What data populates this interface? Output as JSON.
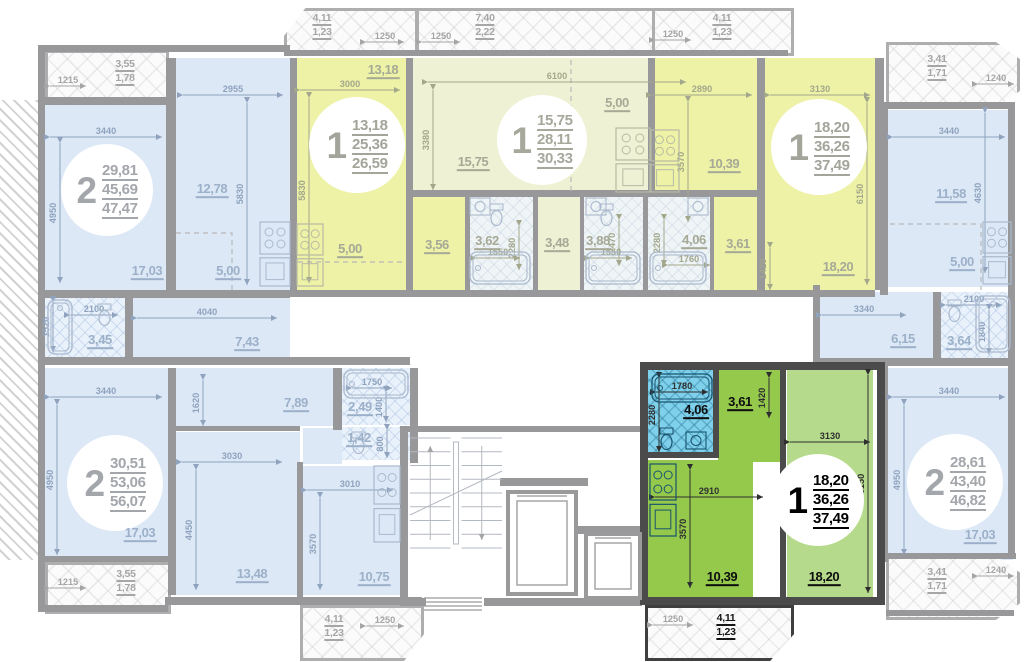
{
  "canvas": {
    "w": 1024,
    "h": 662
  },
  "colors": {
    "wall": "#98989b",
    "wall_selected": "#4b4b4b",
    "room_blue": "#dce8f6",
    "room_yellow": "#edf2a6",
    "room_yellow_pale": "#eef1d3",
    "room_green": "#b6da8c",
    "kitchen_green": "#94c94c",
    "bath_cyan": "#7fd0ea"
  },
  "apartments": [
    {
      "id": "apt-top-left",
      "number": "2",
      "areas": [
        "29,81",
        "45,69",
        "47,47"
      ],
      "cx": 107,
      "cy": 190,
      "d": 92,
      "state": "faded"
    },
    {
      "id": "apt-top-second",
      "number": "1",
      "areas": [
        "13,18",
        "25,36",
        "26,59"
      ],
      "cx": 357,
      "cy": 145,
      "d": 96,
      "state": "hl"
    },
    {
      "id": "apt-top-middle",
      "number": "1",
      "areas": [
        "15,75",
        "28,11",
        "30,33"
      ],
      "cx": 542,
      "cy": 140,
      "d": 90,
      "state": "pale"
    },
    {
      "id": "apt-top-right",
      "number": "1",
      "areas": [
        "18,20",
        "36,26",
        "37,49"
      ],
      "cx": 819,
      "cy": 147,
      "d": 96,
      "state": "hl"
    },
    {
      "id": "apt-right",
      "number": "2",
      "areas": [
        "28,61",
        "43,40",
        "46,82"
      ],
      "cx": 955,
      "cy": 482,
      "d": 96,
      "state": "faded"
    },
    {
      "id": "apt-bottom-left",
      "number": "2",
      "areas": [
        "30,51",
        "53,06",
        "56,07"
      ],
      "cx": 115,
      "cy": 483,
      "d": 96,
      "state": "faded"
    },
    {
      "id": "apt-selected",
      "number": "1",
      "areas": [
        "18,20",
        "36,26",
        "37,49"
      ],
      "cx": 818,
      "cy": 500,
      "d": 92,
      "state": "selected"
    }
  ],
  "rooms": [
    {
      "x": 45,
      "y": 105,
      "w": 123,
      "h": 185,
      "f": "blue",
      "l": "17,03",
      "lx": 147,
      "ly": 272,
      "lc": "b"
    },
    {
      "x": 176,
      "y": 58,
      "w": 116,
      "h": 232,
      "f": "blue",
      "l": "12,78",
      "lx": 212,
      "ly": 190,
      "lc": "b"
    },
    {
      "x": 45,
      "y": 297,
      "w": 80,
      "h": 60,
      "f": "blueTile",
      "l": "3,45",
      "lx": 100,
      "ly": 341,
      "lc": "b"
    },
    {
      "x": 133,
      "y": 297,
      "w": 157,
      "h": 60,
      "f": "blue",
      "l": "7,43",
      "lx": 247,
      "ly": 343,
      "lc": "b"
    },
    {
      "x": 296,
      "y": 58,
      "w": 110,
      "h": 170,
      "f": "yellow",
      "l": "13,18",
      "lx": 383,
      "ly": 71,
      "lc": "y"
    },
    {
      "x": 296,
      "y": 228,
      "w": 110,
      "h": 62,
      "f": "yellow",
      "l": "5,00",
      "lx": 350,
      "ly": 250,
      "lc": "y"
    },
    {
      "x": 410,
      "y": 195,
      "w": 55,
      "h": 95,
      "f": "yellow",
      "l": "3,56",
      "lx": 437,
      "ly": 246,
      "lc": "y"
    },
    {
      "x": 468,
      "y": 195,
      "w": 65,
      "h": 95,
      "f": "tileLight",
      "l": "3,62",
      "lx": 487,
      "ly": 242,
      "lc": "y"
    },
    {
      "x": 413,
      "y": 58,
      "w": 235,
      "h": 137,
      "f": "yellowPale",
      "l": "15,75",
      "lx": 473,
      "ly": 163,
      "lc": "y"
    },
    {
      "x": 537,
      "y": 195,
      "w": 43,
      "h": 95,
      "f": "yellowPale",
      "l": "3,48",
      "lx": 557,
      "ly": 244,
      "lc": "y"
    },
    {
      "x": 583,
      "y": 195,
      "w": 60,
      "h": 95,
      "f": "tileLight",
      "l": "3,88",
      "lx": 598,
      "ly": 242,
      "lc": "y"
    },
    {
      "x": 655,
      "y": 58,
      "w": 102,
      "h": 137,
      "f": "yellow",
      "l": "10,39",
      "lx": 724,
      "ly": 165,
      "lc": "y"
    },
    {
      "x": 765,
      "y": 58,
      "w": 110,
      "h": 232,
      "f": "yellow",
      "l": "18,20",
      "lx": 838,
      "ly": 268,
      "lc": "y"
    },
    {
      "x": 647,
      "y": 195,
      "w": 63,
      "h": 95,
      "f": "tileLight",
      "l": "4,06",
      "lx": 694,
      "ly": 241,
      "lc": "y"
    },
    {
      "x": 713,
      "y": 195,
      "w": 49,
      "h": 95,
      "f": "yellow",
      "l": "3,61",
      "lx": 738,
      "ly": 245,
      "lc": "y"
    },
    {
      "x": 888,
      "y": 110,
      "w": 125,
      "h": 177,
      "f": "blue",
      "l": "11,58",
      "lx": 951,
      "ly": 195,
      "lc": "b"
    },
    {
      "x": 818,
      "y": 292,
      "w": 120,
      "h": 66,
      "f": "blue",
      "l": "6,15",
      "lx": 903,
      "ly": 340,
      "lc": "b"
    },
    {
      "x": 941,
      "y": 292,
      "w": 72,
      "h": 66,
      "f": "blueTile",
      "l": "3,64",
      "lx": 959,
      "ly": 342,
      "lc": "b"
    },
    {
      "x": 888,
      "y": 368,
      "w": 125,
      "h": 192,
      "f": "blue",
      "l": "17,03",
      "lx": 980,
      "ly": 536,
      "lc": "b"
    },
    {
      "x": 45,
      "y": 368,
      "w": 123,
      "h": 192,
      "f": "blue",
      "l": "17,03",
      "lx": 140,
      "ly": 534,
      "lc": "b"
    },
    {
      "x": 176,
      "y": 368,
      "w": 157,
      "h": 58,
      "f": "blue",
      "l": "7,89",
      "lx": 296,
      "ly": 404,
      "lc": "b"
    },
    {
      "x": 176,
      "y": 432,
      "w": 124,
      "h": 163,
      "f": "blue",
      "l": "13,48",
      "lx": 252,
      "ly": 575,
      "lc": "b"
    },
    {
      "x": 303,
      "y": 428,
      "w": 39,
      "h": 36,
      "f": "blue",
      "l": "",
      "lx": 0,
      "ly": 0,
      "lc": "b"
    },
    {
      "x": 303,
      "y": 466,
      "w": 97,
      "h": 129,
      "f": "blue",
      "l": "10,75",
      "lx": 374,
      "ly": 578,
      "lc": "b"
    },
    {
      "x": 342,
      "y": 368,
      "w": 68,
      "h": 57,
      "f": "blueTile",
      "l": "2,49",
      "lx": 360,
      "ly": 408,
      "lc": "b"
    },
    {
      "x": 342,
      "y": 427,
      "w": 68,
      "h": 33,
      "f": "blueTile",
      "l": "1,42",
      "lx": 359,
      "ly": 439,
      "lc": "b"
    },
    {
      "x": 648,
      "y": 370,
      "w": 67,
      "h": 86,
      "f": "greenBath",
      "l": "4,06",
      "lx": 696,
      "ly": 411,
      "lc": "g"
    },
    {
      "x": 718,
      "y": 370,
      "w": 62,
      "h": 92,
      "f": "greenKit",
      "l": "3,61",
      "lx": 740,
      "ly": 403,
      "lc": "g"
    },
    {
      "x": 648,
      "y": 460,
      "w": 105,
      "h": 137,
      "f": "greenKit",
      "l": "10,39",
      "lx": 722,
      "ly": 578,
      "lc": "g"
    },
    {
      "x": 787,
      "y": 370,
      "w": 86,
      "h": 227,
      "f": "greenRoom",
      "l": "18,20",
      "lx": 824,
      "ly": 578,
      "lc": "g"
    }
  ],
  "extra_labels": [
    {
      "t": "5,00",
      "x": 228,
      "y": 272,
      "c": "b"
    },
    {
      "t": "5,00",
      "x": 617,
      "y": 104,
      "c": "y"
    },
    {
      "t": "5,00",
      "x": 962,
      "y": 263,
      "c": "b"
    }
  ],
  "balconies": [
    {
      "x": 45,
      "y": 50,
      "w": 118,
      "h": 47,
      "v1": "3,55",
      "v2": "1,78",
      "lx": 125,
      "ly": 58,
      "clip": "",
      "sel": 0
    },
    {
      "x": 284,
      "y": 8,
      "w": 128,
      "h": 42,
      "v1": "4,11",
      "v2": "1,23",
      "lx": 322,
      "ly": 12,
      "clip": "tl",
      "sel": 0
    },
    {
      "x": 416,
      "y": 8,
      "w": 268,
      "h": 42,
      "v1": "7,40",
      "v2": "2,22",
      "lx": 485,
      "ly": 12,
      "clip": "",
      "sel": 0
    },
    {
      "x": 652,
      "y": 8,
      "w": 136,
      "h": 42,
      "v1": "4,11",
      "v2": "1,23",
      "lx": 722,
      "ly": 12,
      "clip": "",
      "sel": 0
    },
    {
      "x": 886,
      "y": 42,
      "w": 128,
      "h": 60,
      "v1": "3,41",
      "v2": "1,71",
      "lx": 937,
      "ly": 53,
      "clip": "octr",
      "sel": 0
    },
    {
      "x": 886,
      "y": 556,
      "w": 128,
      "h": 58,
      "v1": "3,41",
      "v2": "1,71",
      "lx": 937,
      "ly": 566,
      "clip": "octr",
      "sel": 0
    },
    {
      "x": 45,
      "y": 562,
      "w": 120,
      "h": 46,
      "v1": "3,55",
      "v2": "1,78",
      "lx": 126,
      "ly": 568,
      "clip": "",
      "sel": 0
    },
    {
      "x": 300,
      "y": 605,
      "w": 118,
      "h": 50,
      "v1": "4,11",
      "v2": "1,23",
      "lx": 334,
      "ly": 613,
      "clip": "br",
      "sel": 0
    },
    {
      "x": 645,
      "y": 605,
      "w": 143,
      "h": 50,
      "v1": "4,11",
      "v2": "1,23",
      "lx": 726,
      "ly": 612,
      "clip": "br",
      "sel": 1
    }
  ],
  "dims": [
    {
      "t": "3440",
      "o": "h",
      "x": 50,
      "y": 137,
      "len": 112,
      "c": "b"
    },
    {
      "t": "4950",
      "o": "v",
      "x": 60,
      "y": 143,
      "len": 140,
      "c": "b"
    },
    {
      "t": "2955",
      "o": "h",
      "x": 183,
      "y": 95,
      "len": 100,
      "c": "b"
    },
    {
      "t": "5830",
      "o": "v",
      "x": 247,
      "y": 103,
      "len": 182,
      "c": "b"
    },
    {
      "t": "1215",
      "o": "h",
      "x": 50,
      "y": 86,
      "len": 36,
      "c": "n"
    },
    {
      "t": "2100",
      "o": "h",
      "x": 70,
      "y": 315,
      "len": 48,
      "c": "b"
    },
    {
      "t": "1520",
      "o": "v",
      "x": 53,
      "y": 302,
      "len": 50,
      "c": "b"
    },
    {
      "t": "4040",
      "o": "h",
      "x": 137,
      "y": 318,
      "len": 140,
      "c": "b"
    },
    {
      "t": "3000",
      "o": "h",
      "x": 300,
      "y": 90,
      "len": 100,
      "c": "y"
    },
    {
      "t": "5830",
      "o": "v",
      "x": 309,
      "y": 98,
      "len": 185,
      "c": "y"
    },
    {
      "t": "1250",
      "o": "h",
      "x": 366,
      "y": 42,
      "len": 38,
      "c": "n"
    },
    {
      "t": "1550",
      "o": "h",
      "x": 476,
      "y": 258,
      "len": 44,
      "c": "y"
    },
    {
      "t": "2280",
      "o": "v",
      "x": 519,
      "y": 226,
      "len": 44,
      "c": "y"
    },
    {
      "t": "6100",
      "o": "h",
      "x": 428,
      "y": 82,
      "len": 258,
      "c": "y"
    },
    {
      "t": "3380",
      "o": "v",
      "x": 433,
      "y": 90,
      "len": 100,
      "c": "y"
    },
    {
      "t": "1250",
      "o": "h",
      "x": 422,
      "y": 42,
      "len": 38,
      "c": "n"
    },
    {
      "t": "1550",
      "o": "h",
      "x": 590,
      "y": 258,
      "len": 42,
      "c": "y"
    },
    {
      "t": "2470",
      "o": "v",
      "x": 619,
      "y": 220,
      "len": 46,
      "c": "y"
    },
    {
      "t": "2890",
      "o": "h",
      "x": 652,
      "y": 95,
      "len": 100,
      "c": "y"
    },
    {
      "t": "3570",
      "o": "v",
      "x": 688,
      "y": 102,
      "len": 120,
      "c": "y"
    },
    {
      "t": "3130",
      "o": "h",
      "x": 770,
      "y": 95,
      "len": 100,
      "c": "y"
    },
    {
      "t": "6150",
      "o": "v",
      "x": 867,
      "y": 103,
      "len": 182,
      "c": "y"
    },
    {
      "t": "1420",
      "o": "v",
      "x": 770,
      "y": 248,
      "len": 42,
      "c": "y"
    },
    {
      "t": "1760",
      "o": "h",
      "x": 668,
      "y": 265,
      "len": 42,
      "c": "y"
    },
    {
      "t": "2280",
      "o": "v",
      "x": 664,
      "y": 220,
      "len": 46,
      "c": "y"
    },
    {
      "t": "1250",
      "o": "h",
      "x": 655,
      "y": 40,
      "len": 36,
      "c": "n"
    },
    {
      "t": "1240",
      "o": "h",
      "x": 978,
      "y": 84,
      "len": 36,
      "c": "n"
    },
    {
      "t": "3440",
      "o": "h",
      "x": 893,
      "y": 137,
      "len": 112,
      "c": "b"
    },
    {
      "t": "4630",
      "o": "v",
      "x": 985,
      "y": 113,
      "len": 160,
      "c": "b"
    },
    {
      "t": "3340",
      "o": "h",
      "x": 822,
      "y": 315,
      "len": 84,
      "c": "b"
    },
    {
      "t": "2100",
      "o": "h",
      "x": 946,
      "y": 305,
      "len": 56,
      "c": "b"
    },
    {
      "t": "1840",
      "o": "v",
      "x": 989,
      "y": 310,
      "len": 44,
      "c": "b"
    },
    {
      "t": "3440",
      "o": "h",
      "x": 893,
      "y": 397,
      "len": 112,
      "c": "b"
    },
    {
      "t": "4950",
      "o": "v",
      "x": 904,
      "y": 405,
      "len": 150,
      "c": "b"
    },
    {
      "t": "1240",
      "o": "h",
      "x": 978,
      "y": 576,
      "len": 36,
      "c": "n"
    },
    {
      "t": "3440",
      "o": "h",
      "x": 50,
      "y": 397,
      "len": 112,
      "c": "b"
    },
    {
      "t": "4950",
      "o": "v",
      "x": 57,
      "y": 405,
      "len": 150,
      "c": "b"
    },
    {
      "t": "1620",
      "o": "v",
      "x": 203,
      "y": 380,
      "len": 46,
      "c": "b"
    },
    {
      "t": "3030",
      "o": "h",
      "x": 182,
      "y": 462,
      "len": 100,
      "c": "b"
    },
    {
      "t": "4450",
      "o": "v",
      "x": 196,
      "y": 470,
      "len": 120,
      "c": "b"
    },
    {
      "t": "3010",
      "o": "h",
      "x": 307,
      "y": 490,
      "len": 86,
      "c": "b"
    },
    {
      "t": "3570",
      "o": "v",
      "x": 320,
      "y": 498,
      "len": 92,
      "c": "b"
    },
    {
      "t": "1750",
      "o": "h",
      "x": 352,
      "y": 388,
      "len": 40,
      "c": "b"
    },
    {
      "t": "1400",
      "o": "v",
      "x": 386,
      "y": 392,
      "len": 30,
      "c": "b"
    },
    {
      "t": "800",
      "o": "v",
      "x": 387,
      "y": 430,
      "len": 28,
      "c": "b"
    },
    {
      "t": "1215",
      "o": "h",
      "x": 50,
      "y": 588,
      "len": 36,
      "c": "n"
    },
    {
      "t": "1250",
      "o": "h",
      "x": 366,
      "y": 626,
      "len": 38,
      "c": "n"
    },
    {
      "t": "1780",
      "o": "h",
      "x": 656,
      "y": 392,
      "len": 52,
      "c": "g"
    },
    {
      "t": "2280",
      "o": "v",
      "x": 659,
      "y": 378,
      "len": 74,
      "c": "g"
    },
    {
      "t": "1420",
      "o": "v",
      "x": 769,
      "y": 378,
      "len": 40,
      "c": "g"
    },
    {
      "t": "3130",
      "o": "h",
      "x": 790,
      "y": 442,
      "len": 80,
      "c": "g"
    },
    {
      "t": "6150",
      "o": "v",
      "x": 868,
      "y": 375,
      "len": 218,
      "c": "g"
    },
    {
      "t": "2910",
      "o": "h",
      "x": 655,
      "y": 497,
      "len": 108,
      "c": "g"
    },
    {
      "t": "3570",
      "o": "v",
      "x": 690,
      "y": 470,
      "len": 118,
      "c": "g"
    },
    {
      "t": "1250",
      "o": "h",
      "x": 653,
      "y": 625,
      "len": 40,
      "c": "n"
    }
  ],
  "walls": [
    [
      38,
      45,
      252,
      7
    ],
    [
      284,
      50,
      504,
      6
    ],
    [
      38,
      45,
      7,
      560
    ],
    [
      38,
      605,
      130,
      7
    ],
    [
      165,
      597,
      257,
      8
    ],
    [
      45,
      97,
      130,
      8
    ],
    [
      166,
      58,
      10,
      232
    ],
    [
      290,
      58,
      7,
      232
    ],
    [
      45,
      290,
      245,
      8
    ],
    [
      290,
      290,
      585,
      7
    ],
    [
      38,
      357,
      372,
      8
    ],
    [
      406,
      58,
      7,
      232
    ],
    [
      413,
      190,
      345,
      7
    ],
    [
      648,
      58,
      7,
      139
    ],
    [
      757,
      58,
      8,
      232
    ],
    [
      465,
      195,
      5,
      95
    ],
    [
      533,
      195,
      5,
      95
    ],
    [
      580,
      195,
      4,
      95
    ],
    [
      643,
      195,
      5,
      95
    ],
    [
      710,
      195,
      4,
      95
    ],
    [
      875,
      58,
      9,
      232
    ],
    [
      880,
      102,
      135,
      7
    ],
    [
      880,
      103,
      8,
      192
    ],
    [
      813,
      285,
      7,
      75
    ],
    [
      933,
      292,
      8,
      66
    ],
    [
      813,
      358,
      200,
      8
    ],
    [
      880,
      366,
      8,
      196
    ],
    [
      886,
      553,
      130,
      6
    ],
    [
      886,
      610,
      128,
      6
    ],
    [
      1008,
      102,
      7,
      456
    ],
    [
      125,
      297,
      8,
      60
    ],
    [
      168,
      368,
      8,
      227
    ],
    [
      333,
      368,
      9,
      62
    ],
    [
      410,
      368,
      8,
      95
    ],
    [
      297,
      462,
      6,
      135
    ],
    [
      176,
      426,
      124,
      5
    ],
    [
      400,
      426,
      240,
      6
    ],
    [
      400,
      432,
      8,
      174
    ],
    [
      484,
      598,
      158,
      8
    ],
    [
      408,
      598,
      18,
      8
    ],
    [
      500,
      478,
      88,
      8
    ],
    [
      578,
      526,
      68,
      8
    ],
    [
      45,
      556,
      128,
      6
    ]
  ],
  "dark_walls": [
    [
      640,
      362,
      245,
      8
    ],
    [
      640,
      362,
      8,
      243
    ],
    [
      877,
      362,
      8,
      243
    ],
    [
      640,
      597,
      245,
      8
    ],
    [
      713,
      366,
      6,
      92
    ],
    [
      648,
      452,
      68,
      6
    ],
    [
      780,
      370,
      6,
      227
    ]
  ],
  "hatch": [
    0,
    100,
    38,
    460
  ],
  "dashes": [
    "M176,233H232V290",
    "M298,262H404",
    "M571,60V193",
    "M890,224H981V290"
  ],
  "fixtures": {
    "kitchen_units": [
      [
        260,
        222,
        30,
        64,
        "b"
      ],
      [
        297,
        224,
        26,
        62,
        "y"
      ],
      [
        616,
        128,
        34,
        64,
        "y"
      ],
      [
        651,
        130,
        28,
        62,
        "y"
      ],
      [
        983,
        222,
        28,
        62,
        "b"
      ],
      [
        374,
        466,
        26,
        76,
        "b"
      ],
      [
        650,
        464,
        26,
        72,
        "g"
      ]
    ],
    "bathtubs": [
      [
        48,
        300,
        24,
        54,
        "b",
        "v"
      ],
      [
        470,
        252,
        60,
        32,
        "b",
        "h"
      ],
      [
        586,
        252,
        54,
        32,
        "b",
        "h"
      ],
      [
        650,
        252,
        56,
        32,
        "b",
        "h"
      ],
      [
        976,
        296,
        34,
        56,
        "b",
        "v"
      ],
      [
        344,
        370,
        64,
        28,
        "b",
        "h"
      ],
      [
        652,
        374,
        60,
        28,
        "g",
        "h"
      ]
    ],
    "toilets": [
      [
        98,
        304,
        "b"
      ],
      [
        490,
        204,
        "b"
      ],
      [
        600,
        204,
        "b"
      ],
      [
        948,
        300,
        "b"
      ],
      [
        352,
        432,
        "b"
      ],
      [
        660,
        428,
        "g"
      ]
    ],
    "sink_boxes": [
      [
        470,
        198,
        "b"
      ],
      [
        586,
        198,
        "b"
      ],
      [
        688,
        198,
        "b"
      ],
      [
        686,
        432,
        "g"
      ]
    ]
  },
  "core": {
    "stairs": [
      410,
      438,
      92,
      110
    ],
    "elevators": [
      [
        508,
        492,
        68,
        102
      ],
      [
        586,
        534,
        54,
        64
      ]
    ],
    "entry_steps": [
      424,
      598,
      58,
      12
    ]
  }
}
